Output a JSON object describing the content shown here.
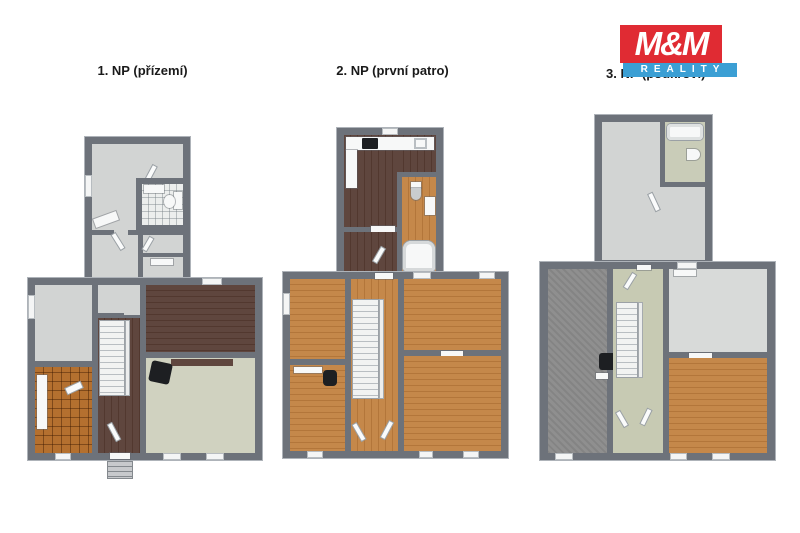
{
  "logo": {
    "top": "M&M",
    "bottom": "REALITY"
  },
  "floors": [
    {
      "label": "1. NP (přízemí)"
    },
    {
      "label": "2. NP (první patro)"
    },
    {
      "label": "3. NP (podkroví)"
    }
  ],
  "colors": {
    "wall": "#6d727a",
    "wall_light": "#aeb3b9",
    "floor_gray": "#d2d4d3",
    "floor_gray2": "#d8dad9",
    "wood_dark": "#5f463e",
    "wood_orange": "#c5884a",
    "tile_orange": "#b4702f",
    "carpet_cream": "#d0d2c0",
    "carpet_gray": "#8f8f8f",
    "sage": "#c7cab3",
    "bath_white": "#eceeed",
    "bath_green": "#c9ccb8",
    "fixture_white": "#f7f8f8",
    "logo_red": "#e02b33",
    "logo_blue": "#3b9fd4"
  }
}
